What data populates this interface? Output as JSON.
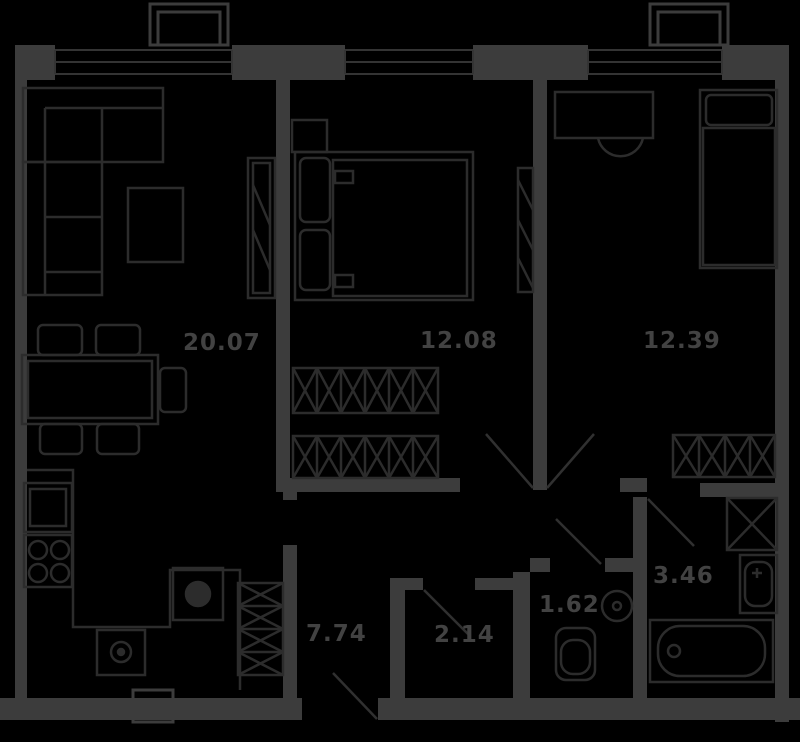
{
  "floor_plan": {
    "title": "two-bedroom apartment floor plan",
    "style": "dark",
    "colors": {
      "background": "#000000",
      "walls": "#3c3c3c",
      "furniture": "#2c2c2c",
      "windows": "#343434",
      "doors": "#303030",
      "labels": "#424242"
    },
    "rooms": [
      {
        "name": "living-room-kitchen",
        "area_label": "20.07"
      },
      {
        "name": "bedroom-1",
        "area_label": "12.08"
      },
      {
        "name": "bedroom-2",
        "area_label": "12.39"
      },
      {
        "name": "hallway",
        "area_label": "7.74"
      },
      {
        "name": "storage",
        "area_label": "2.14"
      },
      {
        "name": "wc",
        "area_label": "1.62"
      },
      {
        "name": "bathroom",
        "area_label": "3.46"
      }
    ]
  }
}
